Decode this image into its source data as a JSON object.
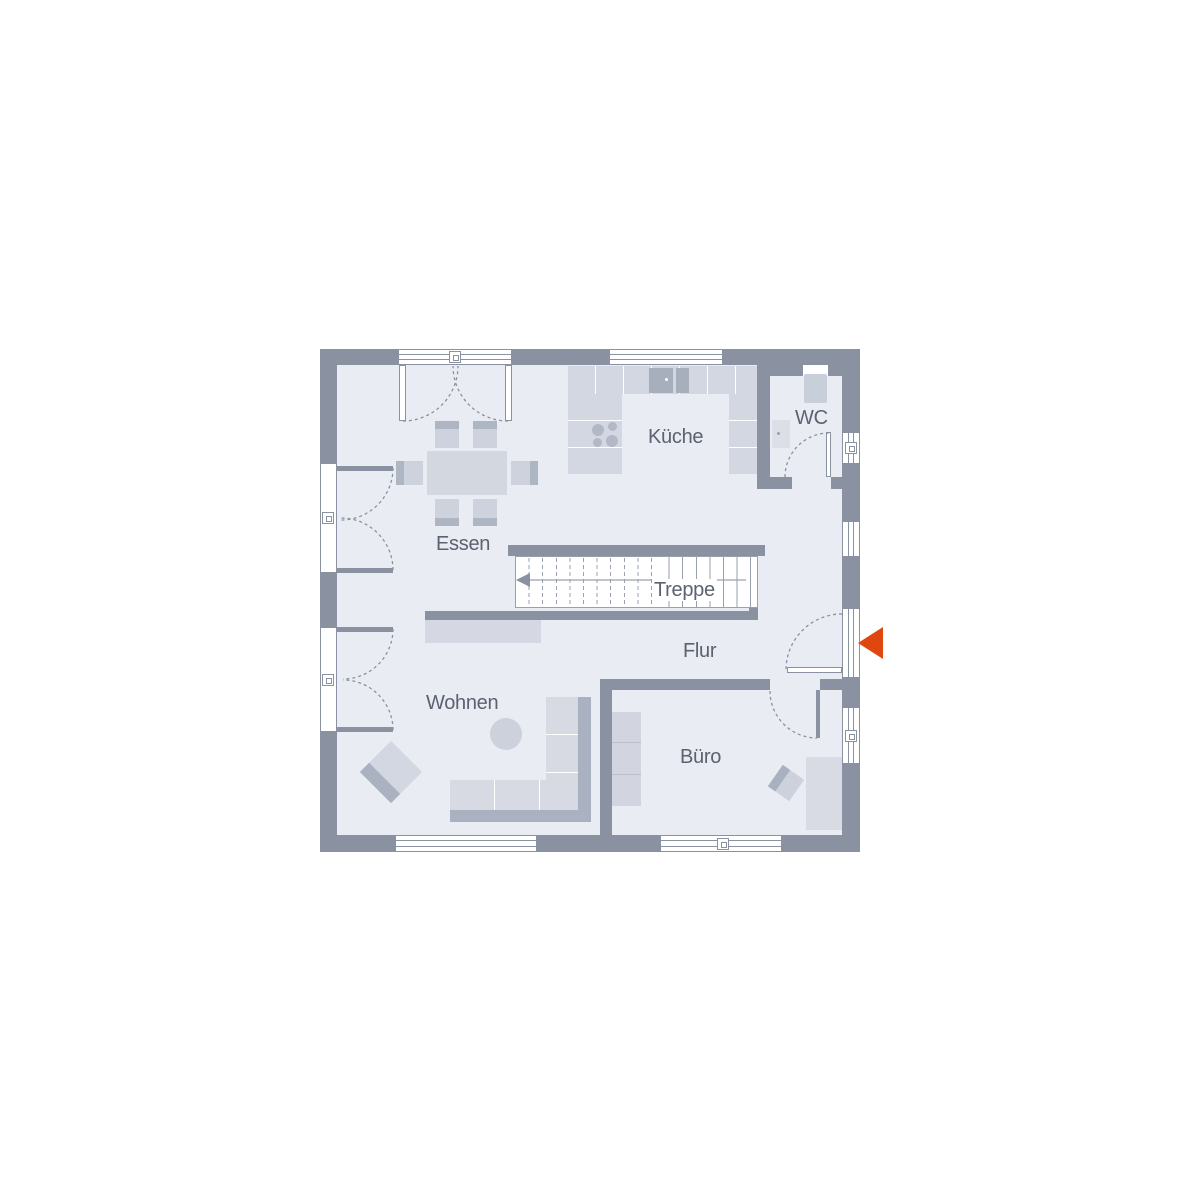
{
  "floor_plan": {
    "type": "residential-ground-floor",
    "rooms": {
      "essen": {
        "label": "Essen"
      },
      "kueche": {
        "label": "Küche"
      },
      "wc": {
        "label": "WC"
      },
      "treppe": {
        "label": "Treppe"
      },
      "flur": {
        "label": "Flur"
      },
      "wohnen": {
        "label": "Wohnen"
      },
      "buero": {
        "label": "Büro"
      }
    },
    "symbols": {
      "entrance_arrow": "left-pointing triangle at entrance door, right exterior wall",
      "stair_direction_arrow": "left-pointing arrow along stair run"
    },
    "colors": {
      "wall": "#8a92a1",
      "floor": "#e9ecf2",
      "furniture_light": "#d7dae3",
      "furniture_medium": "#c8cdd8",
      "furniture_dark": "#aab1c0",
      "stair_line": "#9aa1ae",
      "label_text": "#5b6270",
      "entrance_arrow": "#e0470e"
    }
  }
}
